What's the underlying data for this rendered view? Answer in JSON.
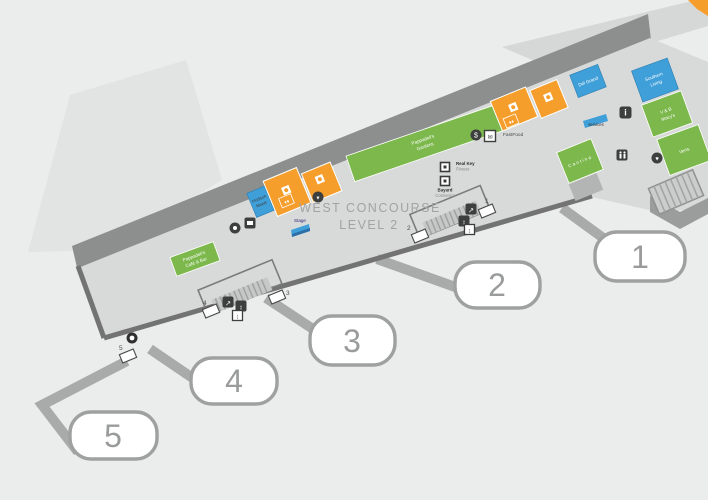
{
  "title": {
    "line1": "WEST CONCOURSE",
    "line2": "LEVEL 2"
  },
  "gates": [
    {
      "number": "1"
    },
    {
      "number": "2"
    },
    {
      "number": "3"
    },
    {
      "number": "4"
    },
    {
      "number": "5"
    }
  ],
  "shops": {
    "news_store": {
      "line1": "Hudson",
      "line2": "News"
    },
    "garden_restaurant": {
      "line1": "Pappadeli's",
      "line2": "Gardens"
    },
    "cafe_bar": {
      "line1": "Pappadeli's",
      "line2": "Café & Bar"
    },
    "fitness_kiosk": {
      "line1": "Real Key",
      "line2": "Fitness"
    },
    "cosmetics_kiosk": {
      "line1": "Bayard",
      "line2": "Cosmetics"
    },
    "fast_food": "FastFood",
    "stage": "Stage",
    "services_flag": "services",
    "bar_store": "Del Grand",
    "southern_living": {
      "line1": "Southern",
      "line2": "Living"
    },
    "macys": {
      "line1": "V & B",
      "line2": "Macy's"
    },
    "verts": "Verts",
    "cantina": "Cantina"
  },
  "icons": {
    "info": "i",
    "dollar": "$",
    "envelope": "✉",
    "escalator": "↗",
    "elevator": "↕",
    "heart": "♥",
    "droplet": "▼",
    "diamond_pair": "♦♦"
  },
  "colors": {
    "orange": "#F59E2C",
    "blue": "#3F9FD9",
    "green": "#7CB84C",
    "floor": "#D8D9D9",
    "band": "#8D8E8E",
    "wall": "#737373",
    "apron": "#E2E3E3",
    "bridge": "#A9AAAA",
    "bubble_border": "#9FA0A0"
  }
}
